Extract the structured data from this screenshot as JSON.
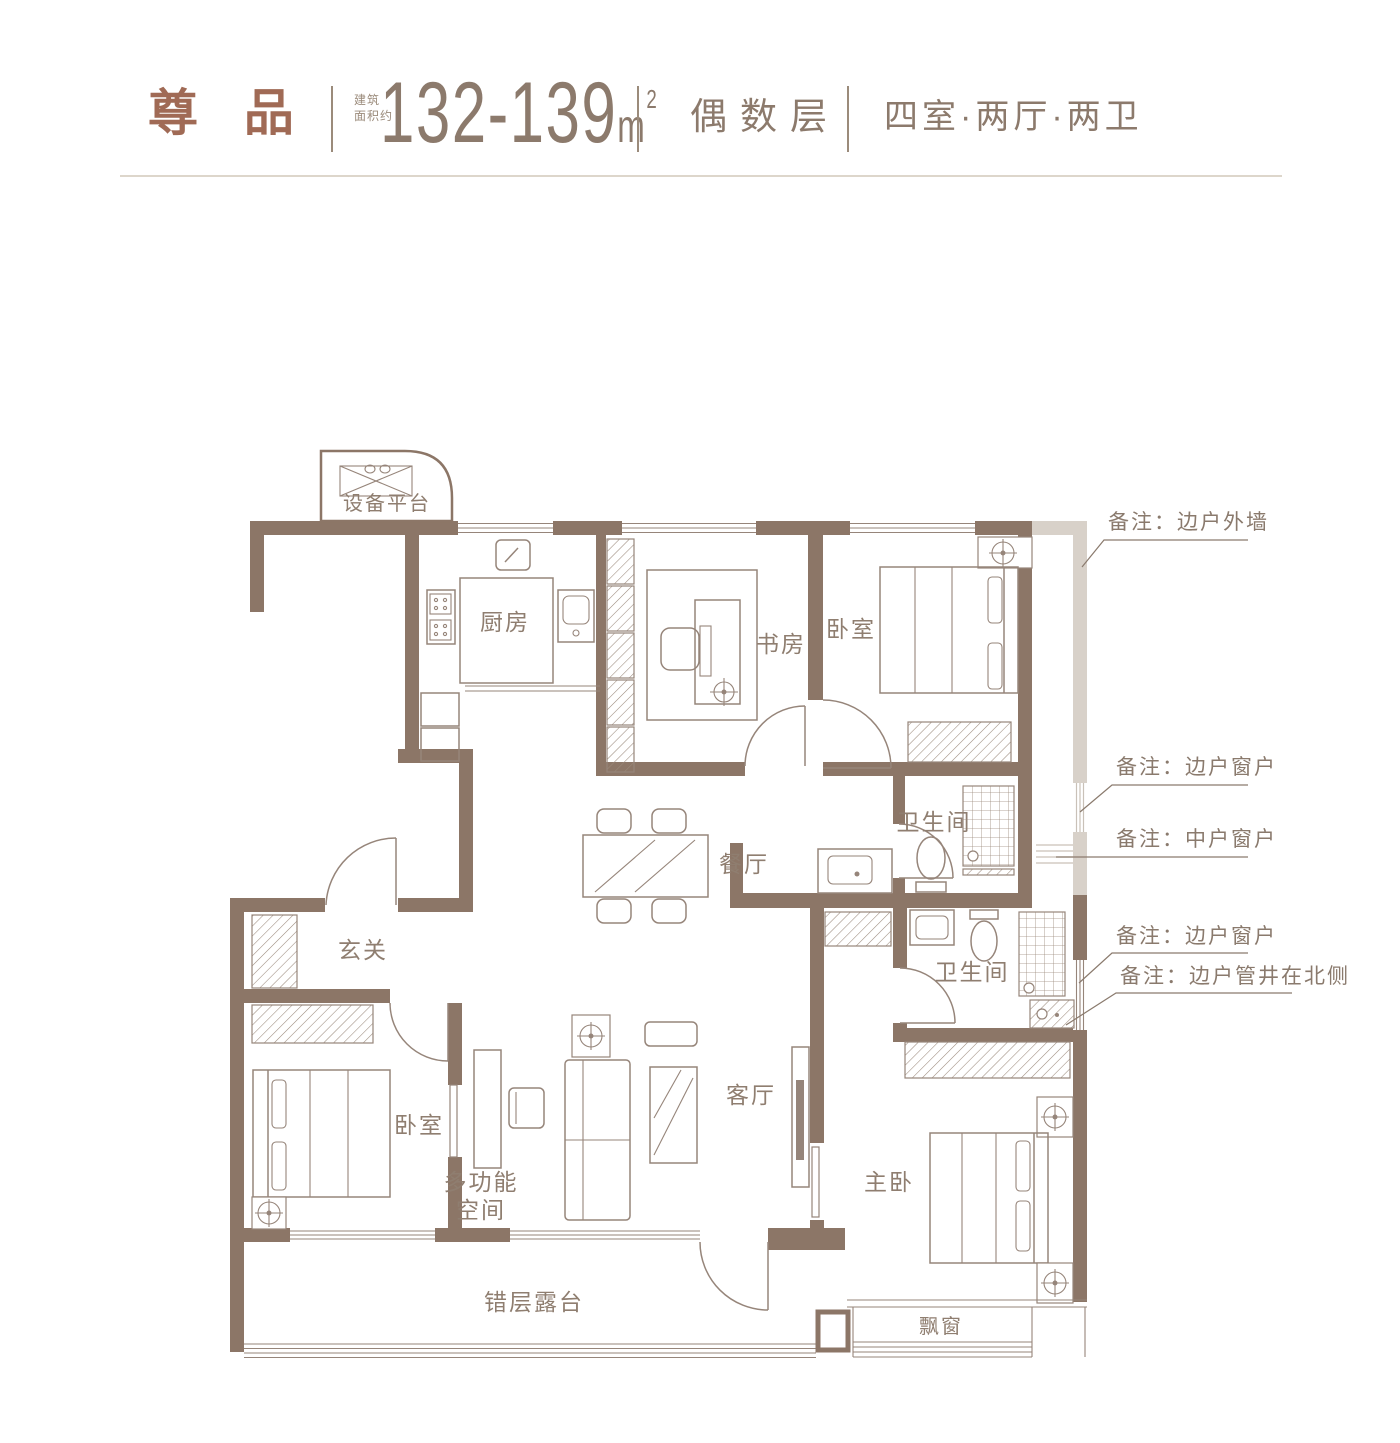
{
  "header": {
    "title": "尊 品",
    "area_label_line1": "建筑",
    "area_label_line2": "面积约",
    "area_value": "132-139",
    "area_unit": "m",
    "area_exponent": "2",
    "floor_type": "偶数层",
    "layout_type": "四室·两厅·两卫"
  },
  "rooms": {
    "equipment_platform": "设备平台",
    "kitchen": "厨房",
    "study": "书房",
    "bedroom_north": "卧室",
    "bathroom_north": "卫生间",
    "dining_room": "餐厅",
    "entry": "玄关",
    "bedroom_west": "卧室",
    "multifunction_line1": "多功能",
    "multifunction_line2": "空间",
    "living_room": "客厅",
    "bathroom_south": "卫生间",
    "master_bedroom": "主卧",
    "terrace": "错层露台",
    "bay_window": "飘窗"
  },
  "notes": {
    "exterior_wall": "备注：边户外墙",
    "side_window_1": "备注：边户窗户",
    "middle_window": "备注：中户窗户",
    "side_window_2": "备注：边户窗户",
    "pipe_shaft": "备注：边户管井在北侧"
  },
  "colors": {
    "wall": "#8c7667",
    "ghost_wall": "#d8d1c9",
    "furniture_line": "#96857a",
    "room_label": "#8f7e70",
    "note_text": "#8a7a6d",
    "title_accent": "#a06a55",
    "header_text": "#8c7a6c",
    "rule": "#ddd6cb"
  }
}
